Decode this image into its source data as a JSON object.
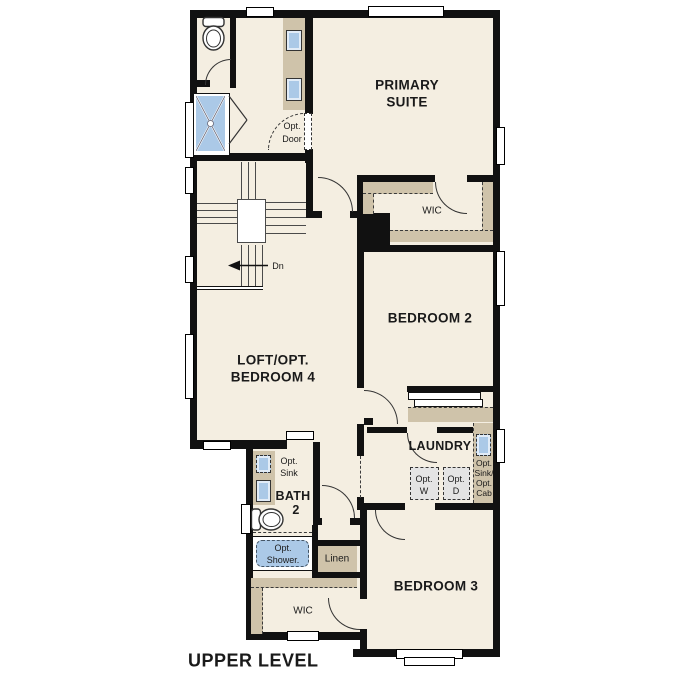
{
  "plan": {
    "title": "UPPER LEVEL",
    "level_type": "floor-plan",
    "rooms": {
      "primary_suite": {
        "line1": "PRIMARY",
        "line2": "SUITE"
      },
      "wic_primary": "WIC",
      "bedroom2": "BEDROOM 2",
      "bedroom3": "BEDROOM 3",
      "loft": {
        "line1": "LOFT/OPT.",
        "line2": "BEDROOM 4"
      },
      "bath2": {
        "line1": "BATH",
        "line2": "2"
      },
      "laundry": "LAUNDRY",
      "linen": "Linen",
      "wic_lower": "WIC"
    },
    "options": {
      "opt_door": {
        "line1": "Opt.",
        "line2": "Door"
      },
      "opt_sink_bath2": {
        "line1": "Opt.",
        "line2": "Sink"
      },
      "opt_shower": {
        "line1": "Opt.",
        "line2": "Shower."
      },
      "opt_washer": {
        "line1": "Opt.",
        "line2": "W"
      },
      "opt_dryer": {
        "line1": "Opt.",
        "line2": "D"
      },
      "opt_sink_cab": {
        "line1": "Opt.",
        "line2": "Sink/",
        "line3": "Opt.",
        "line4": "Cab"
      }
    },
    "stairs": {
      "down_label": "Dn"
    },
    "colors": {
      "wall": "#111111",
      "floor": "#f4eee1",
      "casework": "#cfc3aa",
      "fixture": "#abc9e7",
      "appliance": "#e4e4e4",
      "line": "#333333"
    }
  }
}
